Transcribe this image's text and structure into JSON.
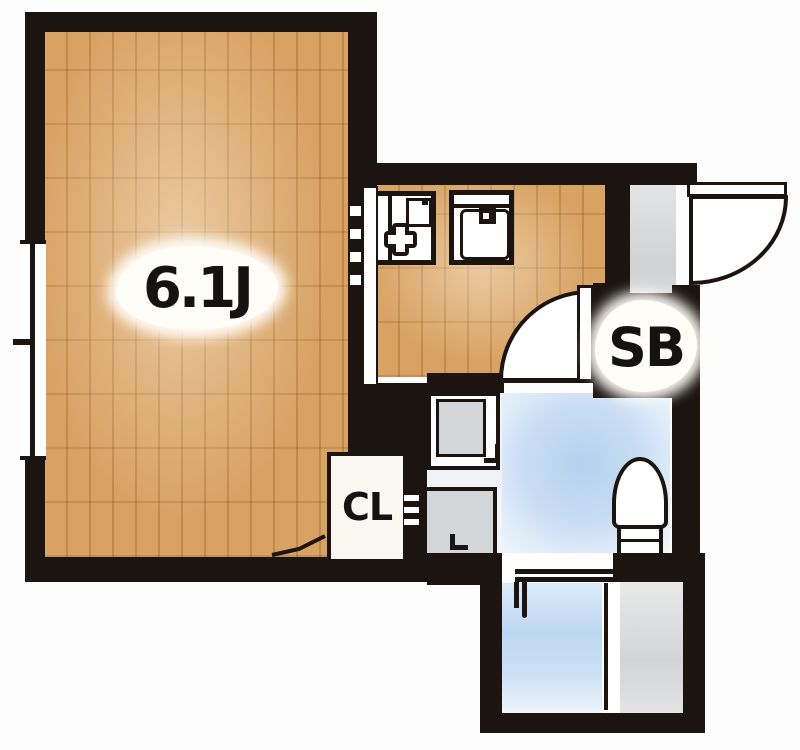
{
  "plan": {
    "type": "apartment-floor-plan",
    "labels": {
      "main_room": "6.1J",
      "shoe_box": "SB",
      "closet": "CL"
    },
    "rooms": [
      "main-room",
      "kitchen",
      "entry",
      "washroom",
      "bathroom",
      "closet"
    ],
    "fixtures": [
      "stove-icon",
      "sink-icon",
      "washbasin-icon",
      "washing-machine-pan-icon",
      "toilet-icon",
      "bathtub",
      "shower-area",
      "tub-faucet-icon",
      "bath-door",
      "entrance-door-swing",
      "washroom-door-swing",
      "closet-door-swing",
      "sliding-door-track",
      "window"
    ],
    "colors": {
      "wall": "#1b1410",
      "wood_floor": "#d8a263",
      "wood_plank_line": "#b07c3e",
      "water_floor": "#bcd5f0",
      "entry_floor": "#d6d7d9",
      "fixture_gray": "#d3d6d8",
      "label_text": "#151311",
      "background": "#fcfcfc"
    }
  }
}
